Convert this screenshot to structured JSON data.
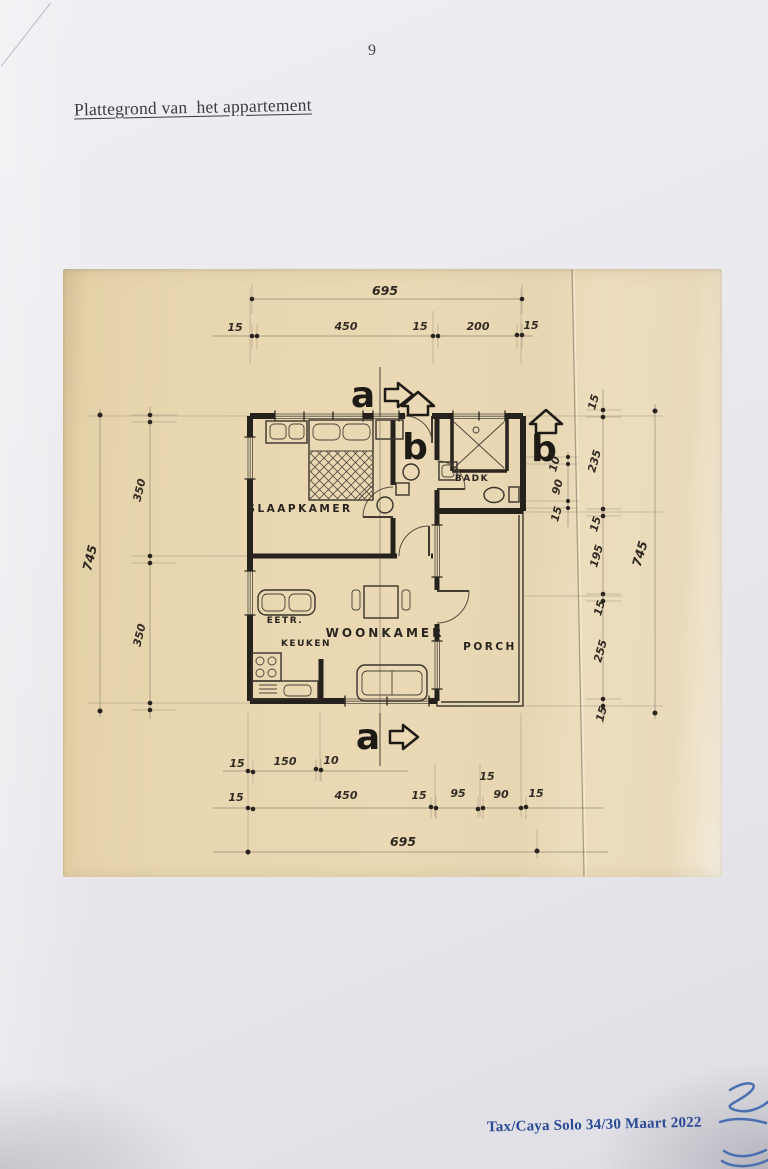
{
  "page": {
    "number": "9",
    "title": "Plattegrond van  het appartement",
    "footer": "Tax/Caya Solo 34/30 Maart 2022"
  },
  "colors": {
    "accent_blue": "#2a4a96",
    "paper": "#e9d8b4",
    "ink": "#2b2520"
  },
  "plan": {
    "rooms": {
      "slaapkamer": "SLAAPKAMER",
      "badk": "BADK",
      "eetr": "EETR.",
      "keuken": "KEUKEN",
      "woonkamer": "WOONKAMER",
      "porch": "PORCH"
    },
    "sections": {
      "a": "a",
      "b": "b"
    },
    "dimensions": {
      "top": {
        "total": "695",
        "chain": [
          "15",
          "450",
          "15",
          "200",
          "15"
        ]
      },
      "bottom": {
        "row1": [
          "15",
          "150",
          "10"
        ],
        "chain": [
          "15",
          "450",
          "15",
          "95",
          "15",
          "90",
          "15"
        ],
        "total": "695"
      },
      "left": {
        "total": "745",
        "chain": [
          "350",
          "350"
        ]
      },
      "right": {
        "total": "745",
        "chain": [
          "15",
          "235",
          "15",
          "195",
          "15",
          "255",
          "15"
        ],
        "inner": [
          "10",
          "90",
          "15"
        ]
      }
    }
  }
}
